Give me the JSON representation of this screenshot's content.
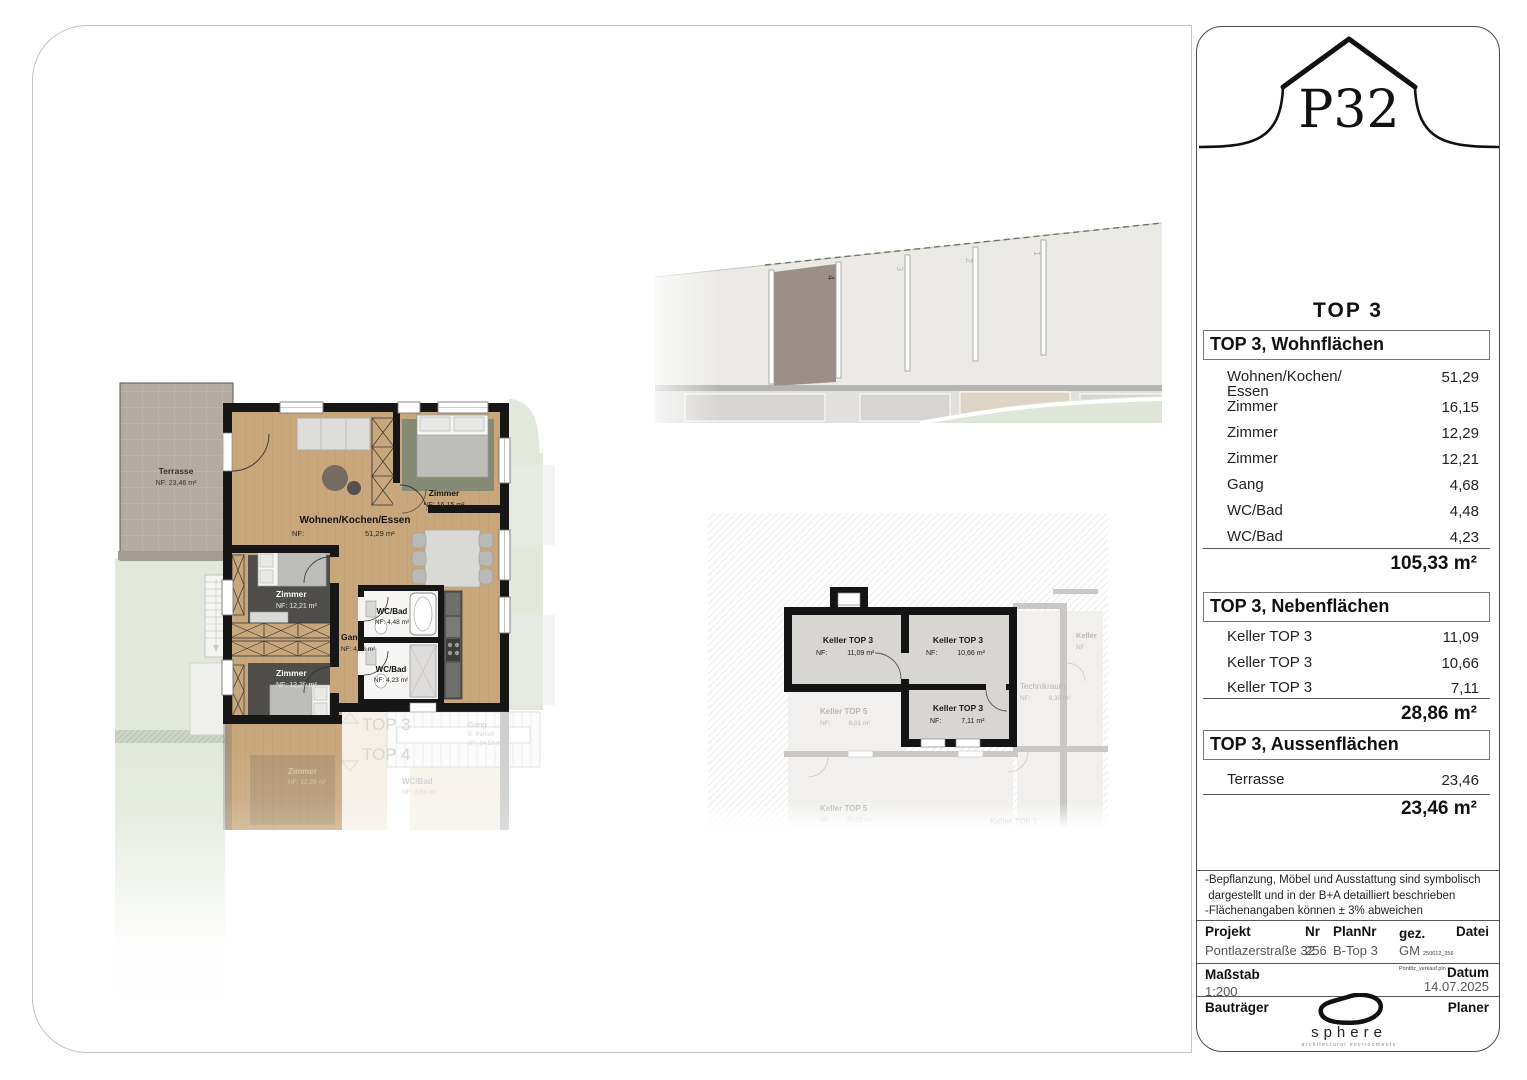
{
  "sidebar": {
    "logo": "P32",
    "unit": "TOP 3",
    "wohnflaechen": {
      "title": "TOP 3, Wohnflächen",
      "rows": [
        {
          "label": "Wohnen/Kochen/ Essen",
          "value": "51,29"
        },
        {
          "label": "Zimmer",
          "value": "16,15"
        },
        {
          "label": "Zimmer",
          "value": "12,29"
        },
        {
          "label": "Zimmer",
          "value": "12,21"
        },
        {
          "label": "Gang",
          "value": "4,68"
        },
        {
          "label": "WC/Bad",
          "value": "4,48"
        },
        {
          "label": "WC/Bad",
          "value": "4,23"
        }
      ],
      "total": "105,33 m²"
    },
    "nebenflaechen": {
      "title": "TOP 3, Nebenflächen",
      "rows": [
        {
          "label": "Keller TOP 3",
          "value": "11,09"
        },
        {
          "label": "Keller TOP 3",
          "value": "10,66"
        },
        {
          "label": "Keller TOP 3",
          "value": "7,11"
        }
      ],
      "total": "28,86 m²"
    },
    "aussenflaechen": {
      "title": "TOP 3, Aussenflächen",
      "rows": [
        {
          "label": "Terrasse",
          "value": "23,46"
        }
      ],
      "total": "23,46 m²"
    },
    "notes": [
      "-Bepflanzung, Möbel und Ausstattung sind symbolisch",
      " dargestellt und in der B+A detailliert beschrieben",
      "-Flächenangaben können ± 3% abweichen"
    ],
    "project": {
      "h_projekt": "Projekt",
      "h_nr": "Nr",
      "h_plannr": "PlanNr",
      "h_gez": "gez.",
      "h_datei": "Datei",
      "projekt": "Pontlazerstraße 32",
      "nr": "256",
      "plannr": "B-Top 3",
      "gez": "GM",
      "datei": "250612_256 Pontltz_verkauf.pln"
    },
    "scale": {
      "label": "Maßstab",
      "value": "1:200"
    },
    "date": {
      "label": "Datum",
      "value": "14.07.2025"
    },
    "developer_label": "Bauträger",
    "planner_label": "Planer",
    "sphere": {
      "name": "sphere",
      "tagline": "architectural environments"
    }
  },
  "main_plan": {
    "terrasse_name": "Terrasse",
    "terrasse_nf": "NF: 23,46 m²",
    "living_name": "Wohnen/Kochen/Essen",
    "living_nf_label": "NF:",
    "living_nf_value": "51,29 m²",
    "room1_name": "Zimmer",
    "room1_nf": "NF: 16,15 m²",
    "room2_name": "Zimmer",
    "room2_nf": "NF: 12,21 m²",
    "room3_name": "Zimmer",
    "room3_nf": "NF: 12,29 m²",
    "gang_name": "Gang",
    "gang_nf": "NF: 4,68 m²",
    "bath1_name": "WC/Bad",
    "bath1_nf": "NF: 4,48 m²",
    "bath2_name": "WC/Bad",
    "bath2_nf": "NF: 4,23 m²",
    "faded_top3": "TOP 3",
    "faded_top4": "TOP 4",
    "faded_gang": "Gang",
    "faded_gang_sub": "B: Parkett",
    "faded_gang_nf": "NF: 14,52 m²",
    "faded_zimmer": "Zimmer",
    "faded_zimmer_nf": "NF: 12,29 m²",
    "faded_bad": "WC/Bad",
    "faded_bad_nf": "NF: 3,98 m²"
  },
  "keller_plan": {
    "room1_name": "Keller TOP 3",
    "room1_nf_label": "NF:",
    "room1_nf_value": "11,09 m²",
    "room2_name": "Keller TOP 3",
    "room2_nf_label": "NF:",
    "room2_nf_value": "10,66 m²",
    "room3_name": "Keller TOP 3",
    "room3_nf_label": "NF:",
    "room3_nf_value": "7,11 m²",
    "faded1_name": "Keller TOP 5",
    "faded1_nf_label": "NF:",
    "faded1_nf_value": "9,01 m²",
    "faded2_name": "Technikraum",
    "faded2_nf_label": "NF:",
    "faded2_nf_value": "9,35 m²",
    "faded3_name": "Keller TOP 5",
    "faded3_nf_label": "NF:",
    "faded3_nf_value": "20,01 m²",
    "faded4_name": "Keller TOP 1",
    "faded5_name": "Keller",
    "faded5_nf": "NF"
  },
  "site_plan": {
    "numbers": [
      "1",
      "2",
      "3",
      "4"
    ]
  },
  "colors": {
    "wood": "#c9a77c",
    "wall": "#161616",
    "terrace": "#b3aaa1",
    "garden": "#e2e9dc",
    "rug_dark": "#4e4d4a",
    "rug_green": "#848a74",
    "parking_highlight": "#9b9089",
    "keller_fill": "#d8d6d2"
  }
}
